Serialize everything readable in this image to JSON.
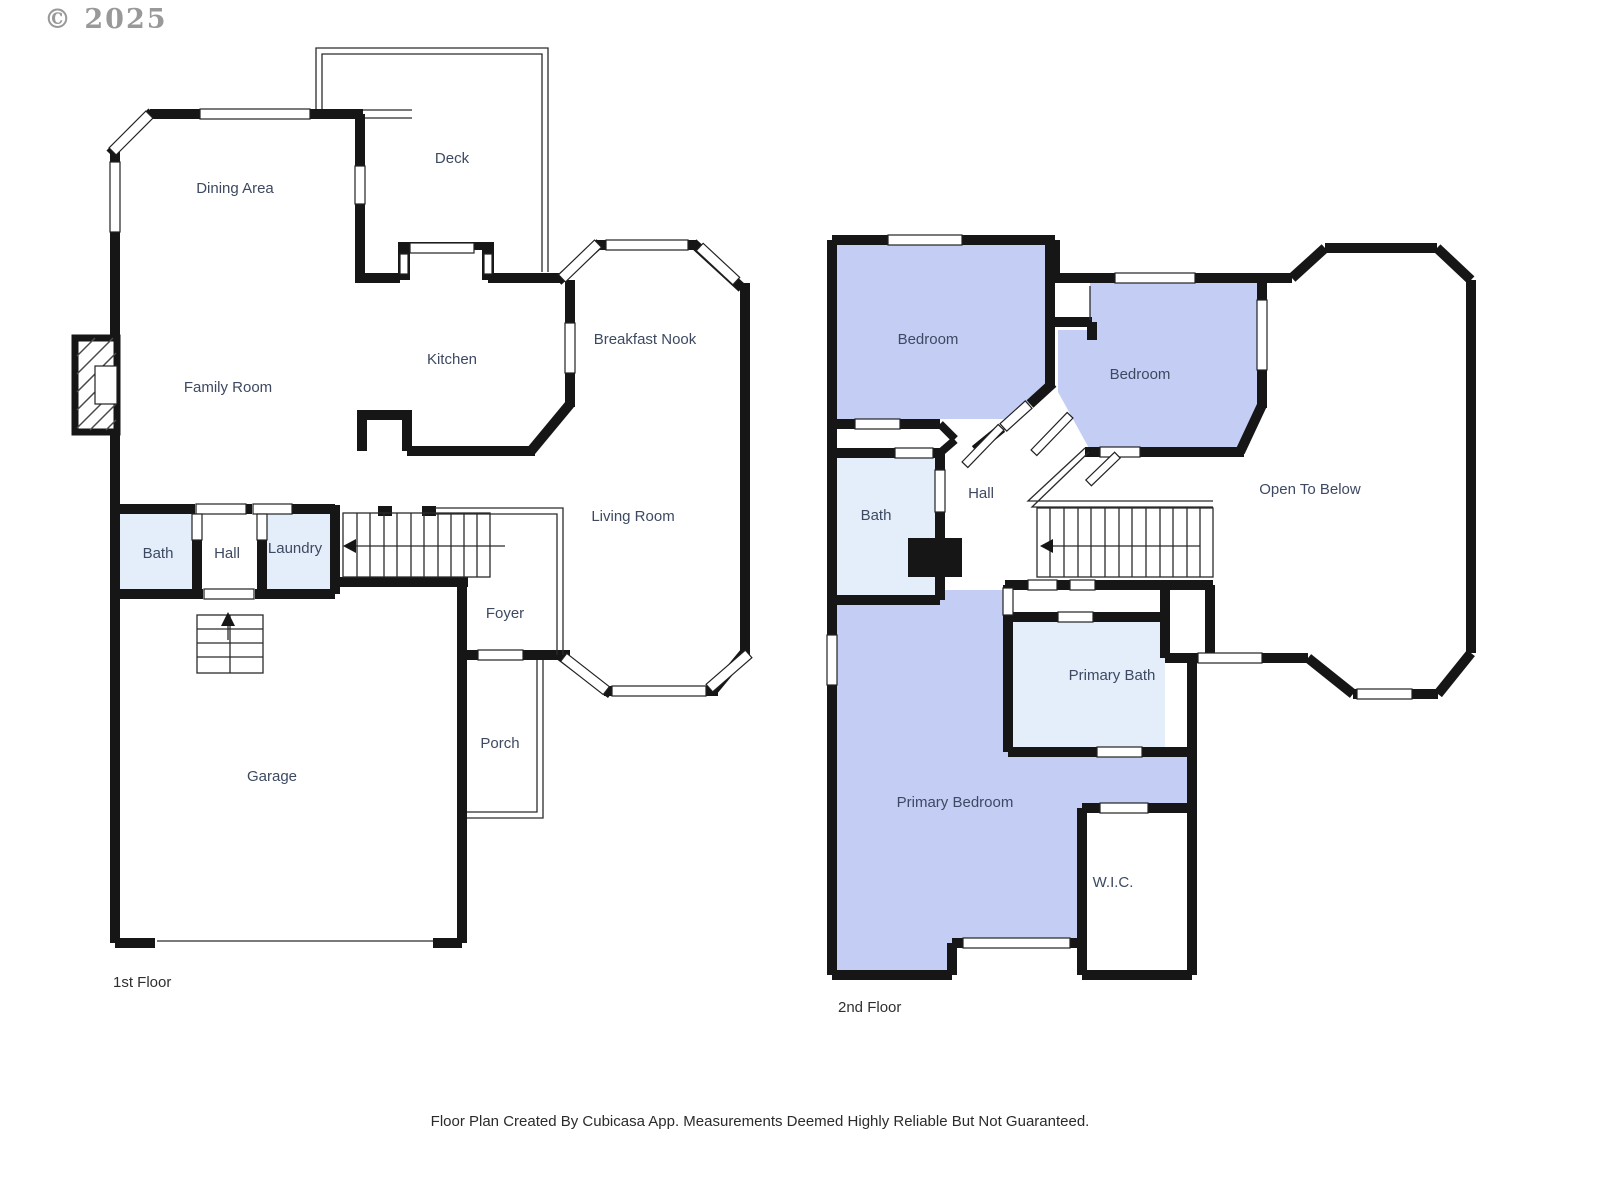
{
  "watermark": "© 2025",
  "disclaimer": "Floor Plan Created By Cubicasa App. Measurements Deemed Highly Reliable But Not Guaranteed.",
  "palette": {
    "wall": "#161616",
    "bedroom_fill": "#c4cef5",
    "bath_fill": "#e4eefb",
    "label_color": "#3d4961",
    "floor_label_color": "#2f2f2f",
    "watermark_color": "#8f8f8f",
    "footer_color": "#2b2b2b"
  },
  "floor1": {
    "label": "1st Floor",
    "rooms": {
      "deck": "Deck",
      "dining": "Dining Area",
      "kitchen": "Kitchen",
      "breakfast_nook": "Breakfast Nook",
      "family": "Family Room",
      "living": "Living Room",
      "bath": "Bath",
      "hall": "Hall",
      "laundry": "Laundry",
      "foyer": "Foyer",
      "porch": "Porch",
      "garage": "Garage"
    }
  },
  "floor2": {
    "label": "2nd Floor",
    "rooms": {
      "bedroom_left": "Bedroom",
      "bedroom_right": "Bedroom",
      "bath": "Bath",
      "hall": "Hall",
      "open_to_below": "Open To Below",
      "primary_bath": "Primary Bath",
      "primary_bedroom": "Primary Bedroom",
      "wic": "W.I.C."
    }
  }
}
